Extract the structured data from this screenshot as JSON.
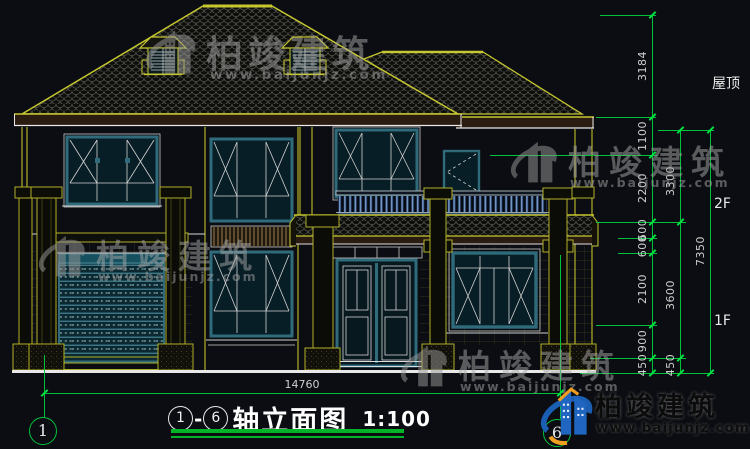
{
  "drawing": {
    "type_note": "front elevation CAD drawing",
    "title": {
      "bubble_left": "1",
      "dash": "-",
      "bubble_right": "6",
      "name": "轴立面图",
      "scale": "1:100"
    },
    "axis_bubbles": {
      "left": "1",
      "right": "6"
    },
    "dims": {
      "bottom_total": "14760",
      "outer_total": "7350",
      "middle": [
        "3300",
        "3600",
        "450"
      ],
      "inner": [
        "3184",
        "1100",
        "2200",
        "600",
        "600",
        "2100",
        "900",
        "450"
      ],
      "levels": {
        "roof": "屋顶",
        "f2": "2F",
        "f1": "1F"
      }
    },
    "watermark": {
      "brand": "柏竣建筑",
      "url": "www.baijunjz.com"
    },
    "badge": {
      "brand": "柏竣建筑",
      "url": "www.baijunjz.com"
    },
    "colors": {
      "background": "#0b0d12",
      "cad_yellow": "#b6b62a",
      "cad_white": "#e8e8e8",
      "dim_green": "#00c23c",
      "frame_teal": "#2f6b7a",
      "railing_blue": "#3a5f95"
    }
  }
}
